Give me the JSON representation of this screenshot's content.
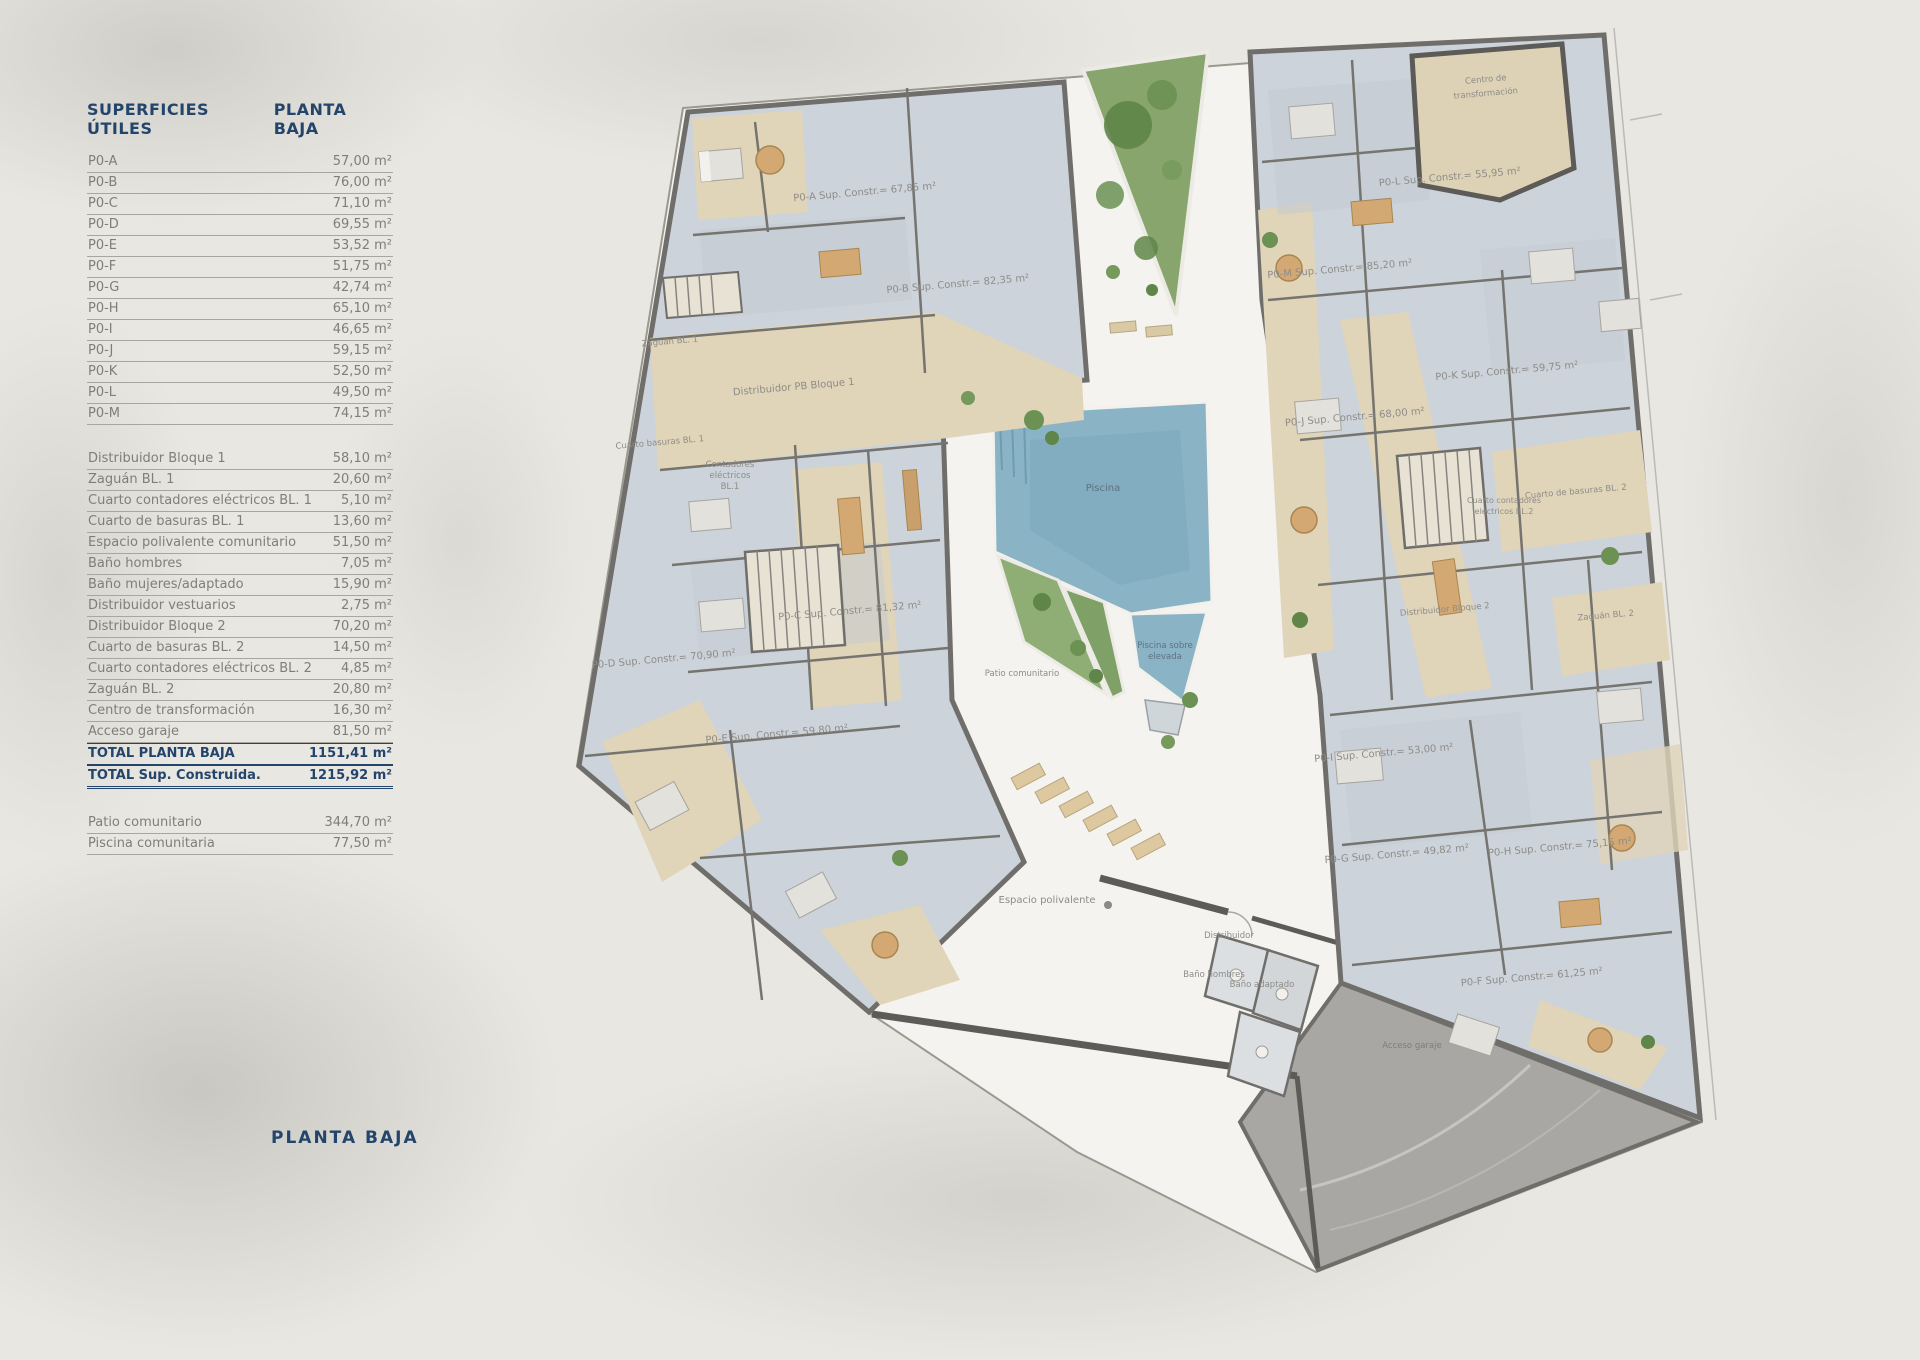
{
  "colors": {
    "navy": "#24456b",
    "row_gray": "#807e7a",
    "wall": "#6f6e6b",
    "room_fill": "#ccd3da",
    "corridor_tan": "#e0d4b9",
    "courtyard": "#f4f3ef",
    "pool_blue": "#8ab3c6",
    "garden_green": "#7fa066",
    "garage_gray": "#a8a7a4",
    "paper": "#e9e7e2"
  },
  "table": {
    "header": {
      "left": "SUPERFICIES ÚTILES",
      "right": "PLANTA BAJA"
    },
    "units": [
      {
        "label": "P0-A",
        "value": "57,00 m²"
      },
      {
        "label": "P0-B",
        "value": "76,00 m²"
      },
      {
        "label": "P0-C",
        "value": "71,10 m²"
      },
      {
        "label": "P0-D",
        "value": "69,55 m²"
      },
      {
        "label": "P0-E",
        "value": "53,52 m²"
      },
      {
        "label": "P0-F",
        "value": "51,75 m²"
      },
      {
        "label": "P0-G",
        "value": "42,74 m²"
      },
      {
        "label": "P0-H",
        "value": "65,10 m²"
      },
      {
        "label": "P0-I",
        "value": "46,65 m²"
      },
      {
        "label": "P0-J",
        "value": "59,15 m²"
      },
      {
        "label": "P0-K",
        "value": "52,50 m²"
      },
      {
        "label": "P0-L",
        "value": "49,50 m²"
      },
      {
        "label": "P0-M",
        "value": "74,15 m²"
      }
    ],
    "common": [
      {
        "label": "Distribuidor Bloque 1",
        "value": "58,10 m²"
      },
      {
        "label": "Zaguán BL. 1",
        "value": "20,60 m²"
      },
      {
        "label": "Cuarto contadores eléctricos BL. 1",
        "value": "5,10 m²"
      },
      {
        "label": "Cuarto de basuras BL. 1",
        "value": "13,60 m²"
      },
      {
        "label": "Espacio polivalente comunitario",
        "value": "51,50 m²"
      },
      {
        "label": "Baño hombres",
        "value": "7,05 m²"
      },
      {
        "label": "Baño mujeres/adaptado",
        "value": "15,90 m²"
      },
      {
        "label": "Distribuidor vestuarios",
        "value": "2,75 m²"
      },
      {
        "label": "Distribuidor Bloque 2",
        "value": "70,20 m²"
      },
      {
        "label": "Cuarto de basuras BL. 2",
        "value": "14,50 m²"
      },
      {
        "label": "Cuarto contadores eléctricos BL. 2",
        "value": "4,85 m²"
      },
      {
        "label": "Zaguán BL. 2",
        "value": "20,80 m²"
      },
      {
        "label": "Centro de transformación",
        "value": "16,30 m²"
      },
      {
        "label": "Acceso garaje",
        "value": "81,50 m²"
      }
    ],
    "totals": [
      {
        "label": "TOTAL PLANTA BAJA",
        "value": "1151,41 m²"
      },
      {
        "label": "TOTAL Sup. Construida.",
        "value": "1215,92 m²"
      }
    ],
    "outdoor": [
      {
        "label": "Patio comunitario",
        "value": "344,70 m²"
      },
      {
        "label": "Piscina comunitaria",
        "value": "77,50 m²"
      }
    ]
  },
  "plan": {
    "title": "PLANTA BAJA",
    "labels": {
      "p0a": "P0-A Sup. Constr.= 67,85 m²",
      "p0b": "P0-B Sup. Constr.= 82,35 m²",
      "p0c": "P0-C Sup. Constr.= 81,32 m²",
      "p0d": "P0-D Sup. Constr.= 70,90 m²",
      "p0e": "P0-E Sup. Constr.= 59,80 m²",
      "p0f": "P0-F Sup. Constr.= 61,25 m²",
      "p0g": "P0-G Sup. Constr.= 49,82 m²",
      "p0h": "P0-H Sup. Constr.= 75,15 m²",
      "p0i": "P0-I Sup. Constr.= 53,00 m²",
      "p0j": "P0-J Sup. Constr.= 68,00 m²",
      "p0k": "P0-K Sup. Constr.= 59,75 m²",
      "p0l": "P0-L Sup. Constr.= 55,95 m²",
      "p0m": "P0-M Sup. Constr.= 85,20 m²",
      "centro_1": "Centro de",
      "centro_2": "transformación",
      "zaguan1": "Zaguán BL. 1",
      "distribuidor1": "Distribuidor PB Bloque 1",
      "basuras1": "Cuarto basuras BL. 1",
      "cont1_1": "Contadores",
      "cont1_2": "eléctricos",
      "cont1_3": "BL.1",
      "piscina": "Piscina",
      "piscina_sobre_1": "Piscina sobre",
      "piscina_sobre_2": "elevada",
      "patio": "Patio comunitario",
      "espacio": "Espacio polivalente",
      "distribuidor_sm": "Distribuidor",
      "bano_hombres": "Baño hombres",
      "bano_adaptado": "Baño adaptado",
      "acceso": "Acceso garaje",
      "distribuidor2": "Distribuidor Bloque 2",
      "zaguan2": "Zaguán BL. 2",
      "basuras2": "Cuarto de basuras BL. 2",
      "cont2_1": "Cuarto contadores",
      "cont2_2": "eléctricos BL.2"
    }
  }
}
